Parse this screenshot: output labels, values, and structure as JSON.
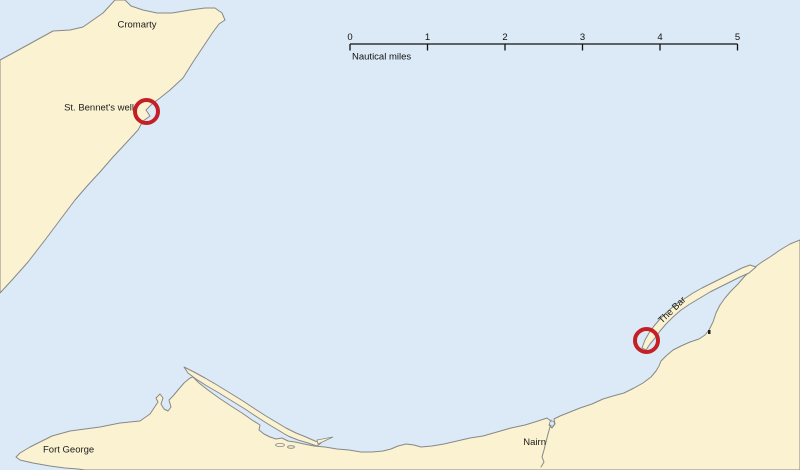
{
  "map": {
    "colors": {
      "sea": "#dbeaf6",
      "land": "#faf2d0",
      "coast": "#888888",
      "marker": "#c51f26",
      "text": "#1c1c1c"
    },
    "place_labels": {
      "cromarty": "Cromarty",
      "st_bennets_well": "St. Bennet's well",
      "fort_george": "Fort George",
      "nairn": "Nairn",
      "the_bar": "The Bar"
    },
    "scale_bar": {
      "unit_label": "Nautical miles",
      "tick_labels": [
        "0",
        "1",
        "2",
        "3",
        "4",
        "5"
      ]
    },
    "markers": [
      {
        "label": "St. Bennet's well",
        "x": 146.5,
        "y": 111.5
      },
      {
        "label": "The Bar",
        "x": 646.5,
        "y": 340.5
      }
    ]
  }
}
